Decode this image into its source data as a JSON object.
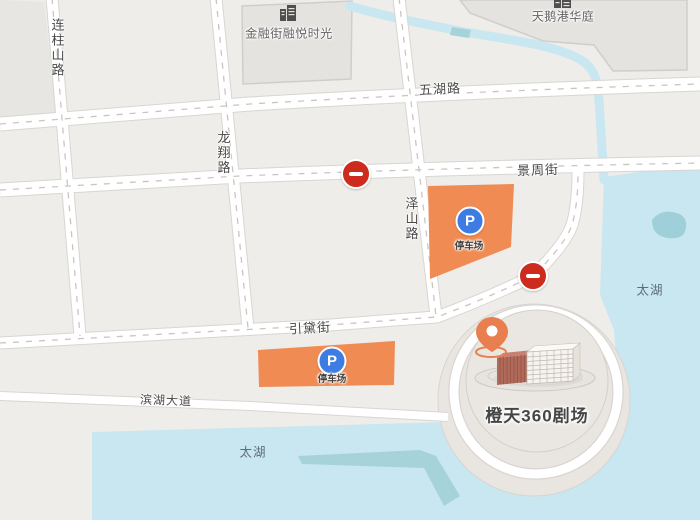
{
  "map": {
    "roads": {
      "lianzhushan": "连柱山路",
      "longxiang": "龙翔路",
      "zeshan": "泽山路",
      "wuhu": "五湖路",
      "jingzhou": "景周街",
      "yindai": "引黛街",
      "binhu": "滨湖大道"
    },
    "blocks": {
      "financial": "金融街融悦时光",
      "swan": "天鹅港华庭"
    },
    "water": {
      "lake_label": "太湖"
    },
    "parking": {
      "label": "停车场",
      "icon_letter": "P"
    },
    "theater": {
      "name": "橙天360剧场"
    },
    "icons": {
      "parking": "parking-icon",
      "no_entry": "no-entry-icon",
      "pin": "location-pin-icon",
      "building": "building-icon"
    },
    "colors": {
      "land": "#EFEDE9",
      "block": "#E5E3E0",
      "water": "#C8E7F1",
      "shallow": "#A6D3DA",
      "parking_orange": "#EF8B53",
      "parking_blue": "#3D7CE3",
      "no_entry_red": "#CC2B1E",
      "pin_orange": "#E97E4E",
      "road": "#FFFFFF"
    }
  }
}
